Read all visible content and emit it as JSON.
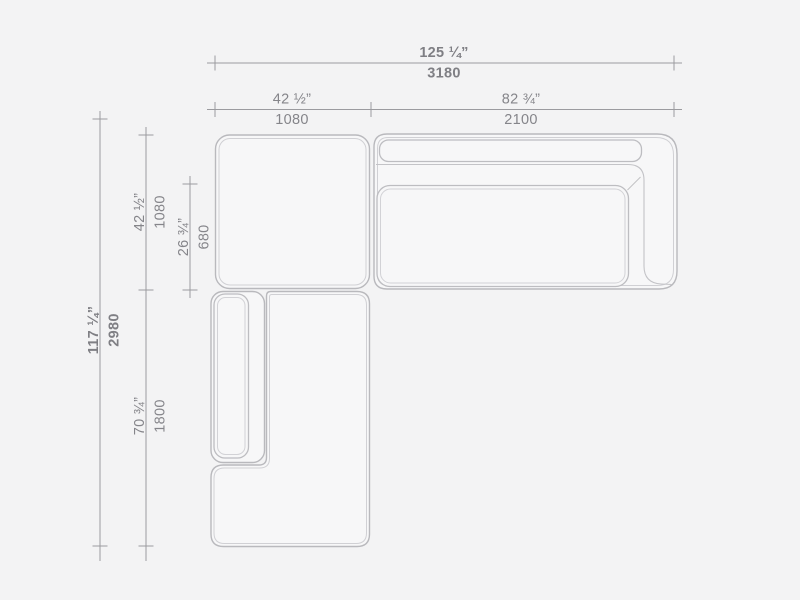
{
  "drawing": {
    "type": "sectional-sofa-top-view-dimension-drawing",
    "units": [
      "inches",
      "millimeters"
    ]
  },
  "dimensions": {
    "horizontal": [
      {
        "name": "overall-width",
        "inches": "125 ¼”",
        "mm": "3180"
      },
      {
        "name": "ottoman-width",
        "inches": "42 ½”",
        "mm": "1080"
      },
      {
        "name": "sofa-width",
        "inches": "82 ¾”",
        "mm": "2100"
      }
    ],
    "vertical": [
      {
        "name": "overall-depth",
        "inches": "117 ¼”",
        "mm": "2980"
      },
      {
        "name": "ottoman-depth",
        "inches": "42 ½”",
        "mm": "1080"
      },
      {
        "name": "seat-depth",
        "inches": "26 ¾”",
        "mm": "680"
      },
      {
        "name": "chaise-length",
        "inches": "70 ¾”",
        "mm": "1800"
      }
    ]
  },
  "colors": {
    "background": "#f3f3f4",
    "module_fill": "#f7f7f8",
    "outline": "#b9b9bd",
    "outline_inset": "#d0d0d4",
    "dimension_line": "#9b9b9f",
    "text": "#85858a"
  }
}
